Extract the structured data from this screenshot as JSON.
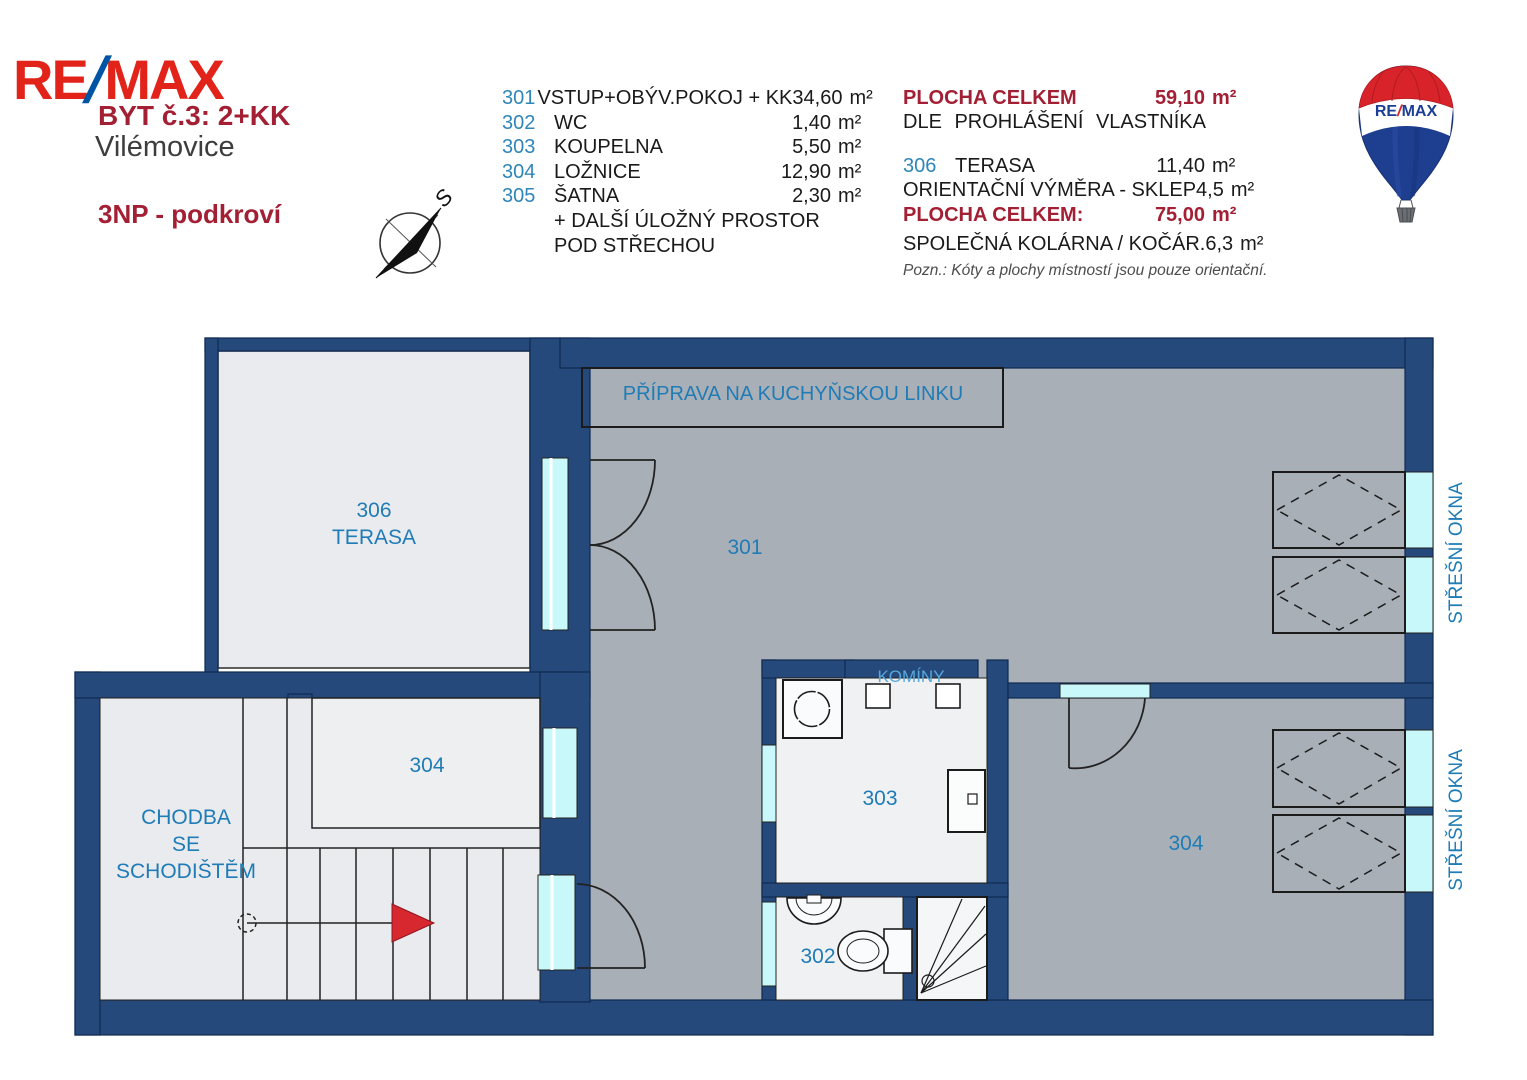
{
  "header": {
    "logo_re": "RE",
    "logo_slash": "/",
    "logo_max": "MAX",
    "unit_title": "BYT č.3:  2+KK",
    "location": "Vilémovice",
    "floor": "3NP - podkroví",
    "compass_north": "S"
  },
  "legend": {
    "rows": [
      {
        "num": "301",
        "name": "VSTUP+OBÝV.POKOJ + KK",
        "area": "34,60",
        "unit": "m²"
      },
      {
        "num": "302",
        "name": "WC",
        "area": "1,40",
        "unit": "m²"
      },
      {
        "num": "303",
        "name": "KOUPELNA",
        "area": "5,50",
        "unit": "m²"
      },
      {
        "num": "304",
        "name": "LOŽNICE",
        "area": "12,90",
        "unit": "m²"
      },
      {
        "num": "305",
        "name": "ŠATNA",
        "area": "2,30",
        "unit": "m²"
      }
    ],
    "extra_line1": "+ DALŠÍ ÚLOŽNÝ PROSTOR",
    "extra_line2": "POD STŘECHOU"
  },
  "summary": {
    "total_label": "PLOCHA CELKEM",
    "total_value": "59,10",
    "total_unit": "m²",
    "total_sub": "DLE PROHLÁŠENÍ VLASTNÍKA",
    "rows": [
      {
        "num": "306",
        "name": "TERASA",
        "area": "11,40",
        "unit": "m²"
      },
      {
        "num": "",
        "name": "ORIENTAČNÍ VÝMĚRA - SKLEP",
        "area": "4,5",
        "unit": "m²"
      },
      {
        "num": "",
        "name": "PLOCHA CELKEM:",
        "area": "75,00",
        "unit": "m²"
      },
      {
        "num": "",
        "name": "SPOLEČNÁ KOLÁRNA / KOČÁR.",
        "area": "6,3",
        "unit": "m²"
      }
    ],
    "note": "Pozn.: Kóty a plochy místností jsou pouze orientační."
  },
  "balloon": {
    "re": "RE",
    "slash": "/",
    "max": "MAX"
  },
  "plan": {
    "labels": {
      "terrace_num": "306",
      "terrace_name": "TERASA",
      "living": "301",
      "bath": "303",
      "wc": "302",
      "closet": "304",
      "bedroom": "304",
      "hall_line1": "CHODBA",
      "hall_line2": "SE",
      "hall_line3": "SCHODIŠTĚM",
      "kitchen": "PŘÍPRAVA NA KUCHYŇSKOU LINKU",
      "chimneys": "KOMÍNY",
      "roof_windows": "STŘEŠNÍ OKNA"
    },
    "colors": {
      "wall": "#26497c",
      "room_gray": "#a9afb7",
      "room_light": "#e9ebee",
      "window_glass": "#c9f8fb",
      "label_blue": "#1f7cb6",
      "arrow_red": "#d8282f",
      "brand_red": "#e2231a",
      "brand_blue": "#0054a4",
      "heading_red": "#a31f34"
    }
  }
}
